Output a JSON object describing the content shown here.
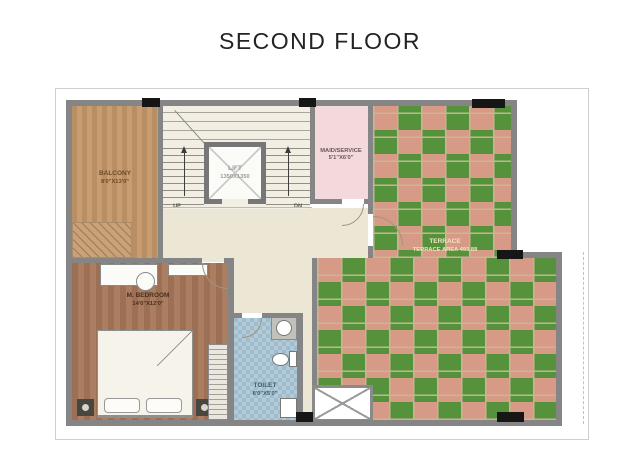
{
  "title": "SECOND FLOOR",
  "plan": {
    "balcony": {
      "name": "BALCONY",
      "dims": "8'0\"X13'0\""
    },
    "stairs": {
      "up_label": "UP",
      "down_label": "DN"
    },
    "lift": {
      "name": "LIFT",
      "dims": "1350X1350"
    },
    "maid_room": {
      "name": "MAID/SERVICE",
      "dims": "5'1\"X6'0\""
    },
    "terrace": {
      "name": "TERRACE",
      "area_label": "TERRACE AREA 493.88"
    },
    "master_bedroom": {
      "name": "M. BEDROOM",
      "dims": "14'0\"X12'0\""
    },
    "toilet": {
      "name": "TOILET",
      "dims": "8'0\"X5'0\""
    }
  },
  "colors": {
    "wall": "#858585",
    "column": "#161616",
    "balcony_wood": "#b98e62",
    "bedroom_wood": "#9d7055",
    "terrace_green": "#55923b",
    "terrace_pink": "#d69a86",
    "maid_pink": "#f4d9dc",
    "toilet_blue": "#a9c3d3",
    "hall_beige": "#ece6d4",
    "title_text": "#232323"
  }
}
